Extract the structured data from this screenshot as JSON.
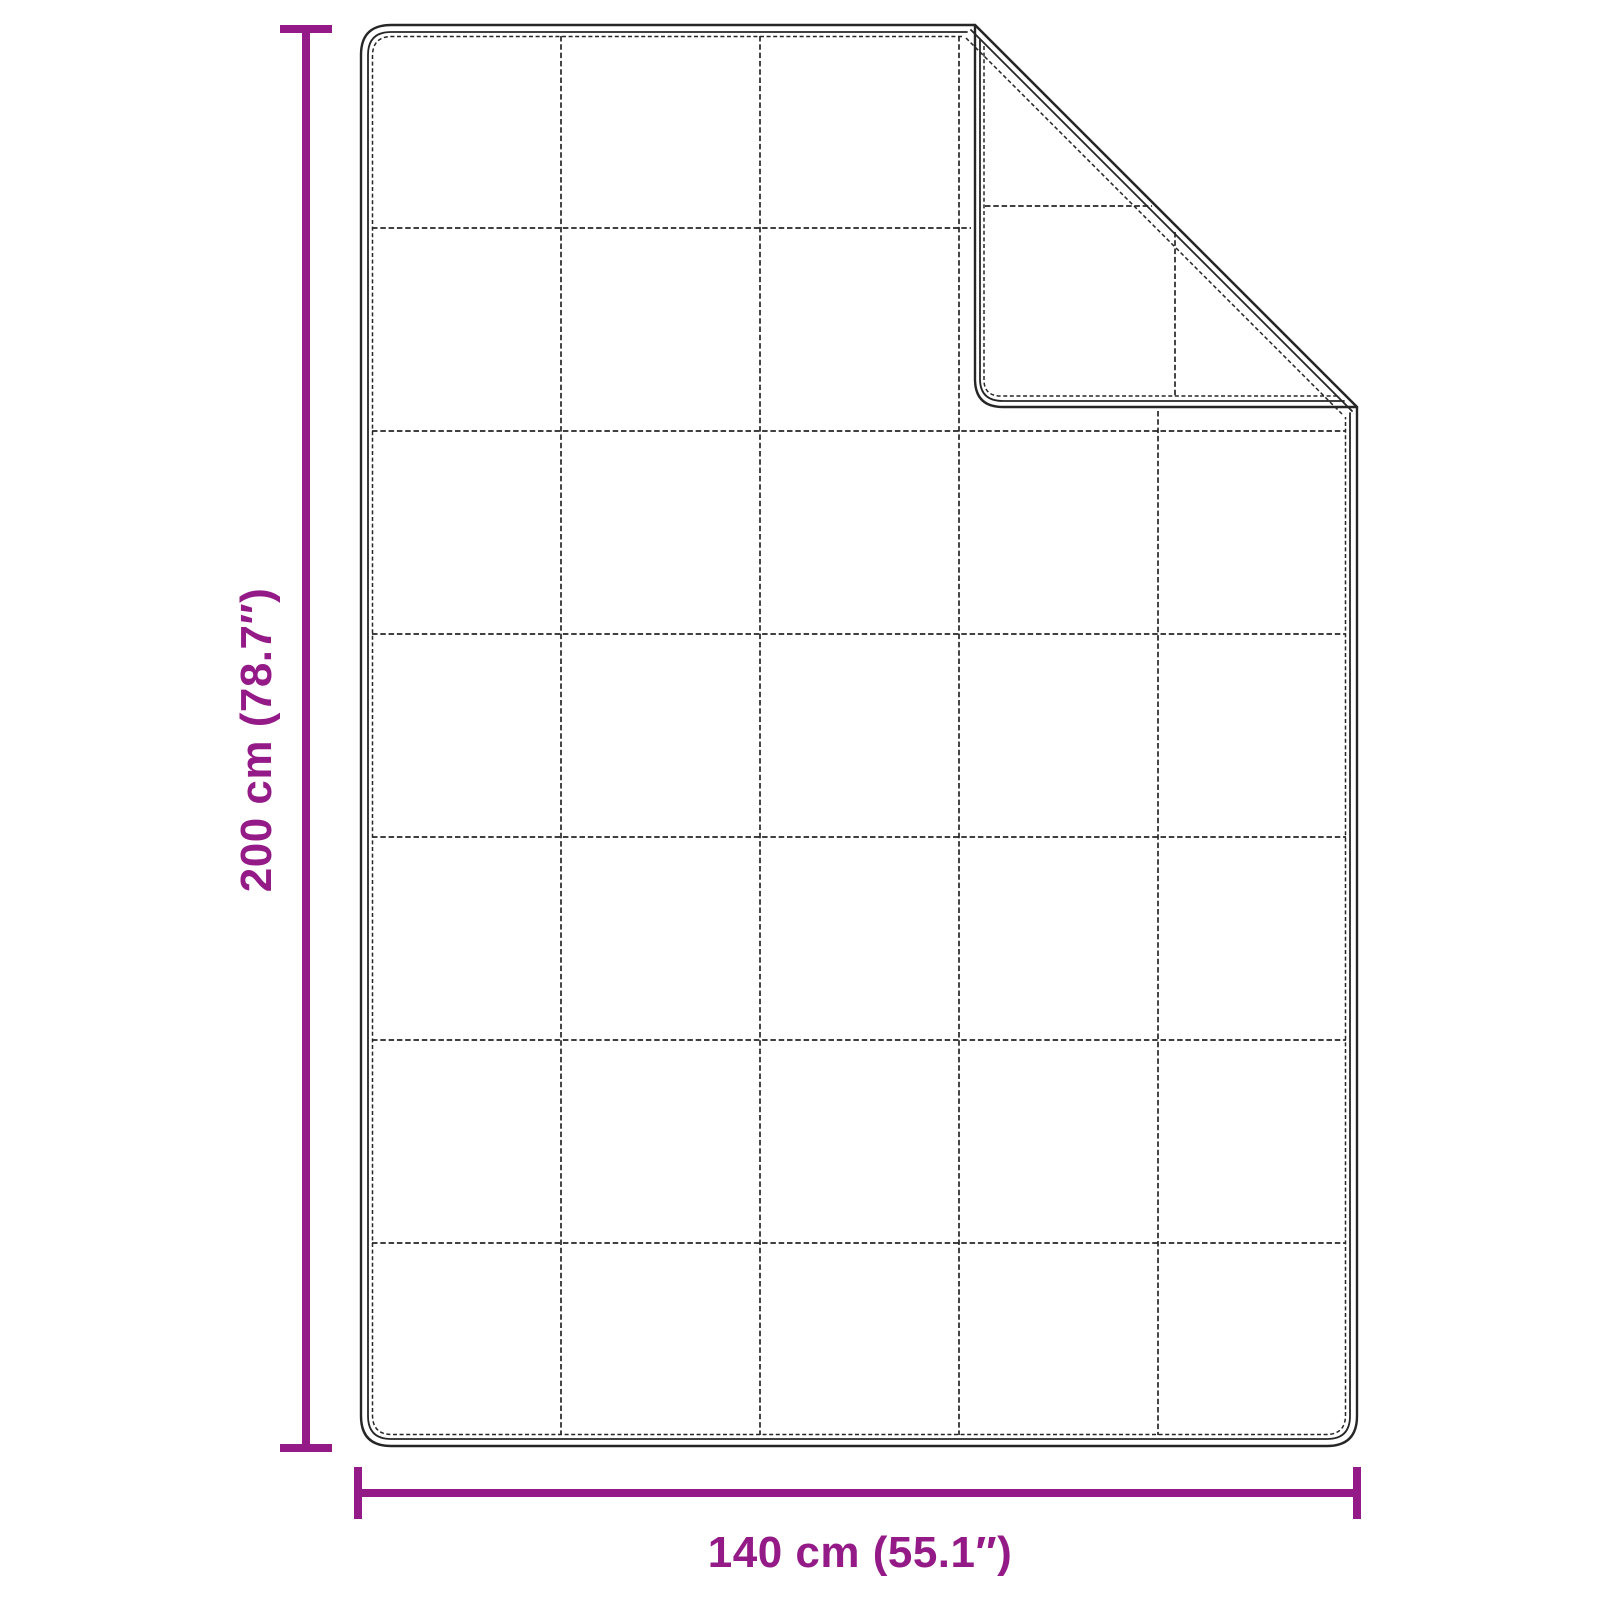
{
  "diagram": {
    "subject": "quilted blanket with folded top-right corner",
    "height_label": "200 cm (78.7″)",
    "width_label": "140 cm (55.1″)",
    "dimensions": {
      "height_cm": 200,
      "height_inches": 78.7,
      "width_cm": 140,
      "width_inches": 55.1
    },
    "quilt_grid": {
      "columns": 5,
      "rows": 7
    },
    "folded_corner": "top-right",
    "colors": {
      "accent": "#941b87",
      "line": "#262626",
      "background": "#ffffff"
    }
  }
}
